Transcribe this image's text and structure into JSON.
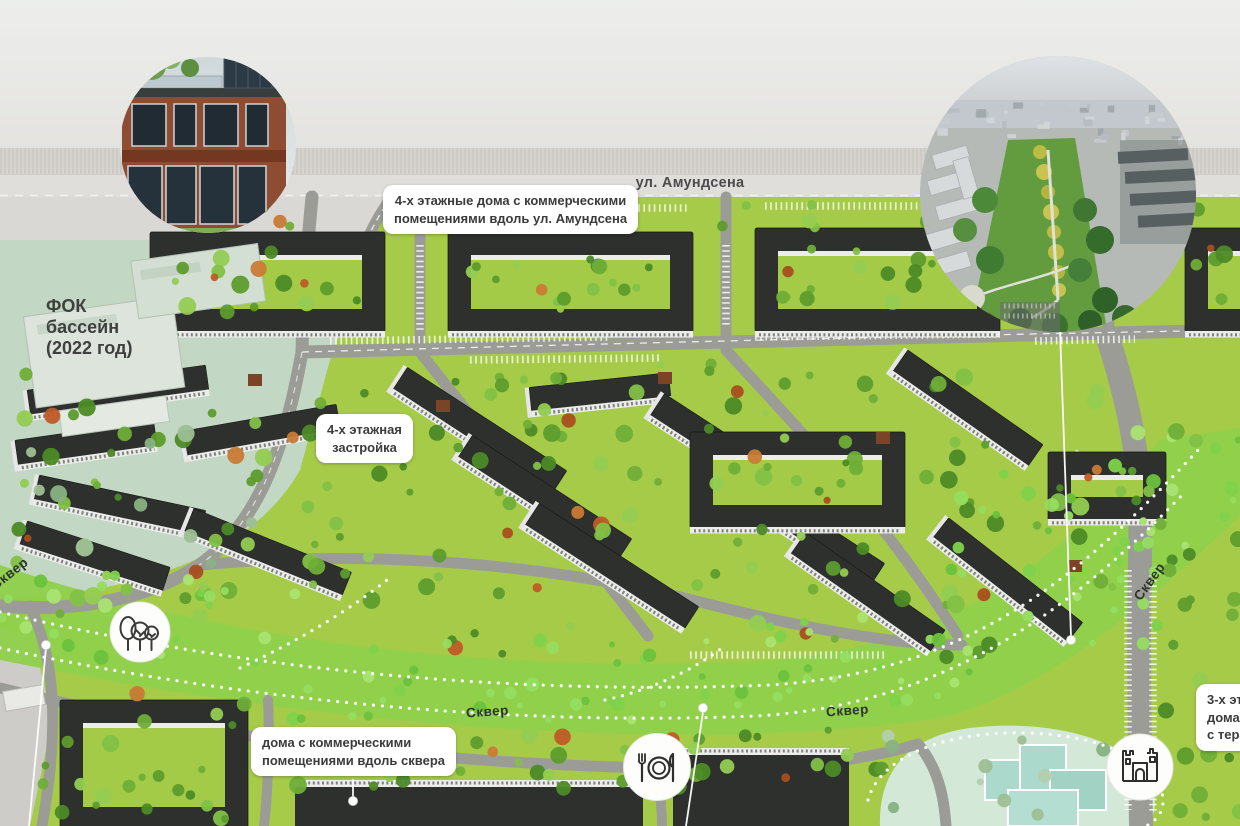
{
  "street_label": "ул. Амундсена",
  "labels": {
    "amundsen_housing": {
      "lines": [
        "4-х этажные дома с коммерческими",
        "помещениями вдоль ул. Амундсена"
      ]
    },
    "four_storey": {
      "lines": [
        "4-х этажная",
        "застройка"
      ]
    },
    "skver_commercial": {
      "lines": [
        "дома с коммерческими",
        "помещениями вдоль сквера"
      ]
    },
    "three_storey_truncated": {
      "lines": [
        "3-х эта",
        "дома",
        "с тера"
      ]
    },
    "fok": {
      "lines": [
        "ФОК",
        "бассейн",
        "(2022 год)"
      ]
    },
    "park": "Сквер"
  },
  "icons": {
    "trees": "trees-icon",
    "restaurant": "restaurant-icon",
    "playground": "playground-castle-icon"
  },
  "colors": {
    "wall_gray": "#e9e8e6",
    "wall_band": "#d6d3ce",
    "street_gray": "#dfdedb",
    "map_green": "#a6cb49",
    "park_green": "#8fd04c",
    "road_gray": "#9c9c97",
    "roof_dark": "#2e302e",
    "facade_white": "#ecedeb",
    "fok_zone": "#c3d8c4",
    "kindergarten_zone": "#d3e8d6",
    "kindergarten_building": "#abd9cb",
    "label_bg": "#ffffff",
    "label_text": "#3b3b3b",
    "leader_white": "#ffffff",
    "tree_accent": "#bf5b26"
  }
}
